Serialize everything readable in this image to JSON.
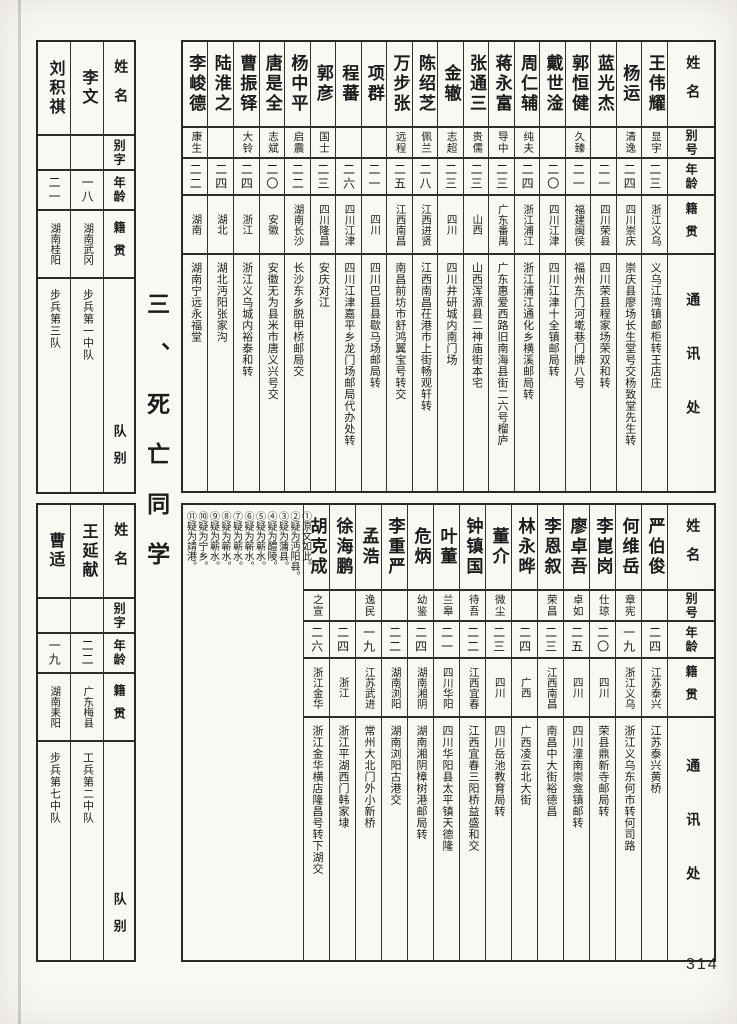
{
  "page": {
    "number": "314",
    "section_title": "三、死亡同学"
  },
  "main_headers": {
    "name": "姓名",
    "alias": "别号",
    "age": "年龄",
    "origin": "籍贯",
    "address": "通讯处"
  },
  "side_headers": {
    "name": "姓名",
    "alias": "别字",
    "age": "年龄",
    "origin": "籍贯",
    "unit": "队别"
  },
  "top_table": {
    "people": [
      {
        "name": "王伟耀",
        "alias": "显宇",
        "age": "二三",
        "origin": "浙江义乌",
        "address": "义乌江湾镇邮柜转王店庄"
      },
      {
        "name": "杨运",
        "alias": "清逸",
        "age": "二四",
        "origin": "四川崇庆",
        "address": "崇庆县廖场长生堂号交杨致堂先生转"
      },
      {
        "name": "蓝光杰",
        "alias": "",
        "age": "二一",
        "origin": "四川荣县",
        "address": "四川荣县程家场荣双和转"
      },
      {
        "name": "郭恒健",
        "alias": "久臻",
        "age": "二一",
        "origin": "福建闽侯",
        "address": "福州东门河墘巷门牌八号"
      },
      {
        "name": "戴世淦",
        "alias": "",
        "age": "二〇",
        "origin": "四川江津",
        "address": "四川江津十全镇邮局转"
      },
      {
        "name": "周仁辅",
        "alias": "纯夫",
        "age": "二四",
        "origin": "浙江浦江",
        "address": "浙江浦江通化乡横溪邮局转"
      },
      {
        "name": "蒋永富",
        "alias": "导中",
        "age": "二三",
        "origin": "广东番禺",
        "address": "广东惠爱西路旧南海县街二六号榴庐"
      },
      {
        "name": "张通三",
        "alias": "贵儒",
        "age": "二三",
        "origin": "山西",
        "address": "山西浑源县二神庙街本宅"
      },
      {
        "name": "金辙",
        "alias": "志超",
        "age": "二三",
        "origin": "四川",
        "address": "四川井研城内南门场"
      },
      {
        "name": "陈绍芝",
        "alias": "佩兰",
        "age": "二八",
        "origin": "江西进贤",
        "address": "江西南昌茌港市上街畅观轩转"
      },
      {
        "name": "万步张",
        "alias": "远程",
        "age": "二五",
        "origin": "江西南昌",
        "address": "南昌前坊市舒鸿翼宝号转交"
      },
      {
        "name": "项群",
        "alias": "",
        "age": "二一",
        "origin": "四川",
        "address": "四川巴县县歇马场邮局转"
      },
      {
        "name": "程蕃",
        "alias": "",
        "age": "二六",
        "origin": "四川江津",
        "address": "四川江津嘉平乡龙门场邮局代办处转"
      },
      {
        "name": "郭彦",
        "alias": "国士",
        "age": "二三",
        "origin": "四川隆昌",
        "address": "安庆对江"
      },
      {
        "name": "杨中平",
        "alias": "启震",
        "age": "二二",
        "origin": "湖南长沙",
        "address": "长沙东乡脱甲桥邮局交"
      },
      {
        "name": "唐是全",
        "alias": "志斌",
        "age": "二〇",
        "origin": "安徽",
        "address": "安徽无为县米市唐义兴号交"
      },
      {
        "name": "曹振铎",
        "alias": "大铃",
        "age": "二四",
        "origin": "浙江",
        "address": "浙江义乌城内裕泰和转"
      },
      {
        "name": "陆淮之",
        "alias": "",
        "age": "二四",
        "origin": "湖北",
        "address": "湖北沔阳张家沟"
      },
      {
        "name": "李峻德",
        "alias": "康生",
        "age": "二二",
        "origin": "湖南",
        "address": "湖南宁远永福堂"
      }
    ]
  },
  "bottom_table": {
    "people": [
      {
        "name": "严伯俊",
        "alias": "",
        "age": "二四",
        "origin": "江苏泰兴",
        "address": "江苏泰兴黄桥"
      },
      {
        "name": "何维岳",
        "alias": "章宪",
        "age": "一九",
        "origin": "浙江义乌",
        "address": "浙江义乌东何市转何司路"
      },
      {
        "name": "李崑岗",
        "alias": "仕琼",
        "age": "二〇",
        "origin": "四川",
        "address": "荣县鼎新寺邮局转"
      },
      {
        "name": "廖卓吾",
        "alias": "卓如",
        "age": "二五",
        "origin": "四川",
        "address": "四川潼南崇龛镇邮转"
      },
      {
        "name": "李恩叙",
        "alias": "荣昌",
        "age": "二三",
        "origin": "江西南昌",
        "address": "南昌中大街裕德昌"
      },
      {
        "name": "林永晔",
        "alias": "",
        "age": "二四",
        "origin": "广西",
        "address": "广西凌云北大街"
      },
      {
        "name": "董介",
        "alias": "微尘",
        "age": "二三",
        "origin": "四川",
        "address": "四川岳池教育局转"
      },
      {
        "name": "钟镇国",
        "alias": "待吾",
        "age": "二二",
        "origin": "江西宜春",
        "address": "江西宜春三阳桥益盛和交"
      },
      {
        "name": "叶董",
        "alias": "兰皋",
        "age": "二一",
        "origin": "四川华阳",
        "address": "四川华阳县太平镇天德隆"
      },
      {
        "name": "危炳",
        "alias": "幼鉴",
        "age": "二四",
        "origin": "湖南湘阴",
        "address": "湖南湘阴樟树港邮局转"
      },
      {
        "name": "李重严",
        "alias": "",
        "age": "二二",
        "origin": "湖南浏阳",
        "address": "湖南浏阳古港交"
      },
      {
        "name": "孟浩",
        "alias": "逸民",
        "age": "一九",
        "origin": "江苏武进",
        "address": "常州大北门外小新桥"
      },
      {
        "name": "徐海鹏",
        "alias": "",
        "age": "二四",
        "origin": "浙江",
        "address": "浙江平湖西门韩家埭"
      },
      {
        "name": "胡克成",
        "alias": "之宣",
        "age": "二六",
        "origin": "浙江金华",
        "address": "浙江金华横店隆昌号转下湖交"
      }
    ],
    "footnotes": [
      {
        "mark": "①",
        "text": "原文如此。"
      },
      {
        "mark": "②",
        "text": "疑为沔阳县。"
      },
      {
        "mark": "③",
        "text": "疑为蒲县。"
      },
      {
        "mark": "④",
        "text": "疑为醴陵。"
      },
      {
        "mark": "⑤",
        "text": "疑为蕲水。"
      },
      {
        "mark": "⑥",
        "text": "疑为蕲水。"
      },
      {
        "mark": "⑦",
        "text": "疑为蕲水。"
      },
      {
        "mark": "⑧",
        "text": "疑为蕲水。"
      },
      {
        "mark": "⑨",
        "text": "疑为蕲水。"
      },
      {
        "mark": "⑩",
        "text": "疑为宁乡。"
      },
      {
        "mark": "⑪",
        "text": "疑为靖港。"
      }
    ]
  },
  "side_top_table": {
    "people": [
      {
        "name": "李文",
        "alias": "",
        "age": "一八",
        "origin": "湖南武冈",
        "unit": "步兵第一中队"
      },
      {
        "name": "刘积祺",
        "alias": "",
        "age": "二一",
        "origin": "湖南桂阳",
        "unit": "步兵第三队"
      }
    ]
  },
  "side_bottom_table": {
    "people": [
      {
        "name": "王延献",
        "alias": "",
        "age": "二二",
        "origin": "广东梅县",
        "unit": "工兵第二中队"
      },
      {
        "name": "曹适",
        "alias": "",
        "age": "一九",
        "origin": "湖南耒阳",
        "unit": "步兵第七中队"
      }
    ]
  }
}
